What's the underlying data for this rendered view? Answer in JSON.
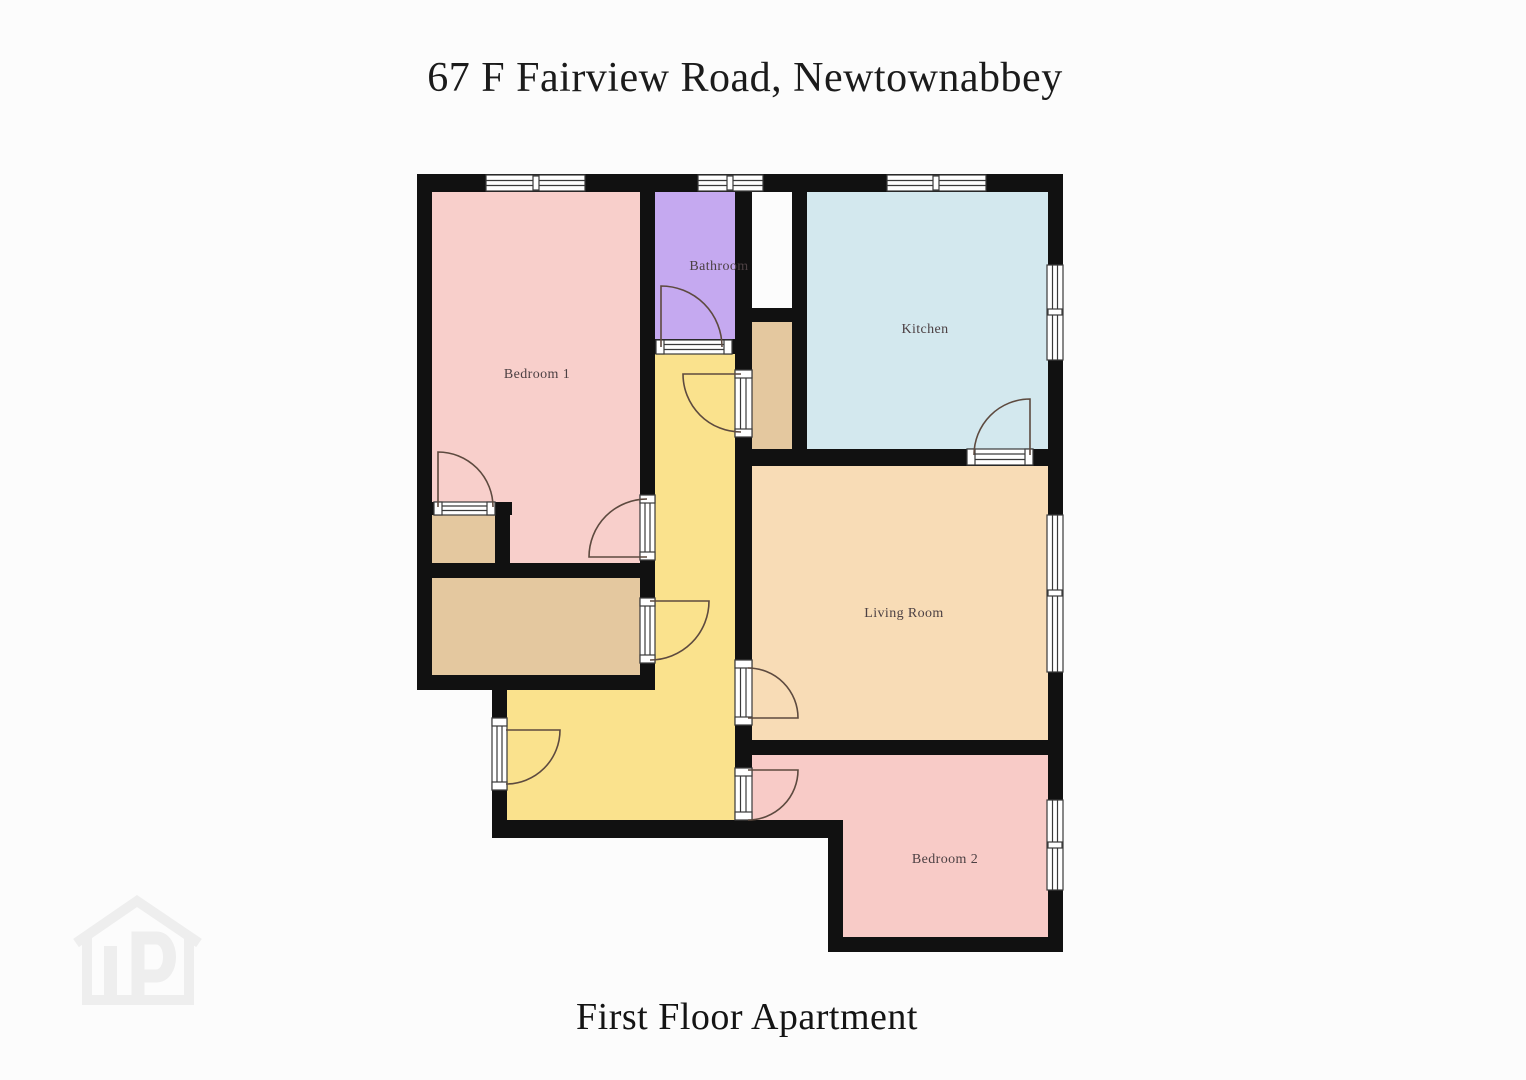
{
  "header": {
    "title": "67 F Fairview Road, Newtownabbey"
  },
  "footer": {
    "caption": "First Floor Apartment"
  },
  "floorplan": {
    "rooms": [
      {
        "label": "Bedroom 1"
      },
      {
        "label": "Bathroom"
      },
      {
        "label": "Kitchen"
      },
      {
        "label": "Living Room"
      },
      {
        "label": "Bedroom 2"
      }
    ],
    "colors": {
      "bedroom1": "#f8cfcb",
      "bathroom": "#c5a9f0",
      "kitchen": "#d3e8ee",
      "living": "#f8dcb6",
      "bedroom2": "#f8cbc7",
      "hallway": "#fae28d",
      "storage": "#e4c89f",
      "wall": "#111111",
      "door_arc": "#5d4a3f",
      "label_text": "#4c4043",
      "frame_stroke": "#3a3a3a",
      "background": "#fcfcfc",
      "watermark": "#eeeeee"
    }
  },
  "watermark": {
    "icon": "house-p-logo"
  }
}
